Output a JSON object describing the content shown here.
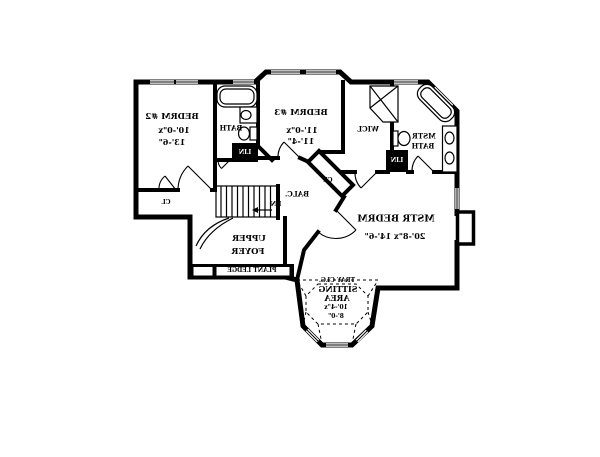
{
  "page": {
    "type": "floor-plan",
    "floor": "second floor",
    "text_mirrored": true
  },
  "colors": {
    "ink": "#000000",
    "background": "#ffffff"
  },
  "rooms": {
    "bedrm2": {
      "name": "BEDRM #2",
      "dim1": "10'-0\"x",
      "dim2": "13'-6\""
    },
    "bath": {
      "name": "BATH"
    },
    "bedrm3": {
      "name": "BEDRM #3",
      "dim1": "11'-0\"x",
      "dim2": "11'-4\""
    },
    "wicl": {
      "name": "WICL"
    },
    "mstr_bath": {
      "name1": "MSTR",
      "name2": "BATH"
    },
    "mstr_bedrm": {
      "name": "MSTR BEDRM",
      "dims": "20'-8\"x 14'-6\""
    },
    "sitting": {
      "note": "TRAY CLG.",
      "name1": "SITTING",
      "name2": "AREA",
      "dim1": "10'-4\"x",
      "dim2": "8'-0\""
    },
    "upper_foyer": {
      "name1": "UPPER",
      "name2": "FOYER"
    },
    "balcony": {
      "name": "BALC."
    },
    "plant_ledge": {
      "name": "PLANT LEDGE"
    },
    "stairs": {
      "name": "DN"
    },
    "closet_hall": {
      "name": "CL"
    },
    "closet_diag": {
      "name": "CL"
    },
    "linen_hall": {
      "name": "LIN"
    },
    "linen_mstr": {
      "name": "LIN"
    }
  }
}
